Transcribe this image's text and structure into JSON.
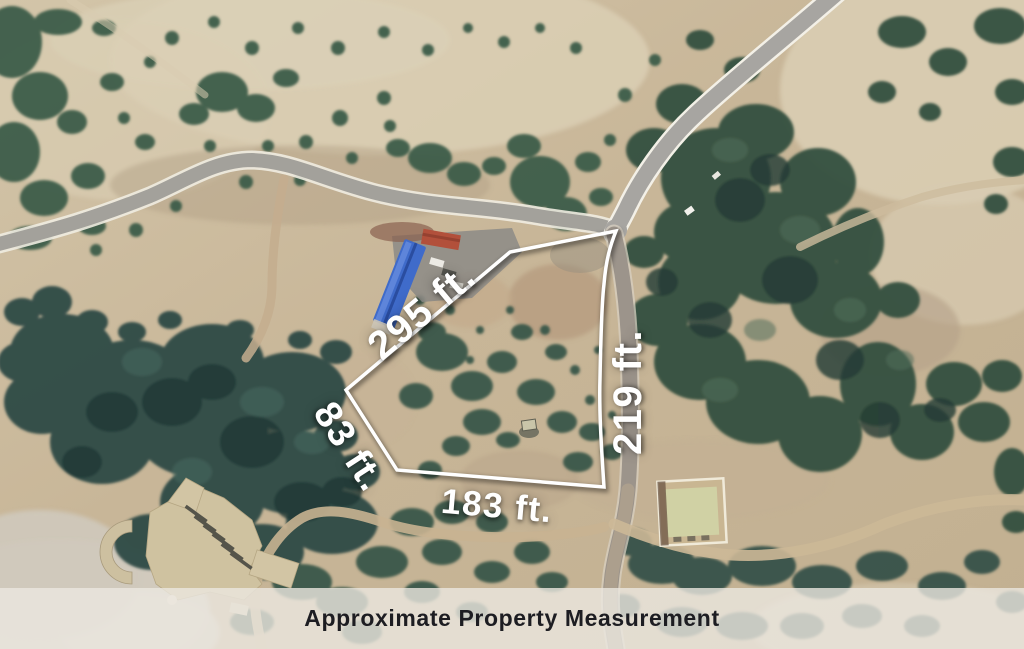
{
  "measurements": {
    "top_edge": "295 ft.",
    "right_edge": "219 ft.",
    "left_edge": "83 ft.",
    "bottom_edge": "183 ft."
  },
  "caption": {
    "text": "Approximate Property Measurement"
  },
  "colors": {
    "boundary_line": "#ffffff",
    "label_text": "#ffffff",
    "caption_text": "#1d1d22",
    "caption_bar": "#ebe7e0",
    "terrain_tan": "#c8b698",
    "tree_green": "#33503f",
    "road_gray": "#a5a3a0",
    "blue_roof": "#3f6bca",
    "red_roof": "#b2503b"
  }
}
